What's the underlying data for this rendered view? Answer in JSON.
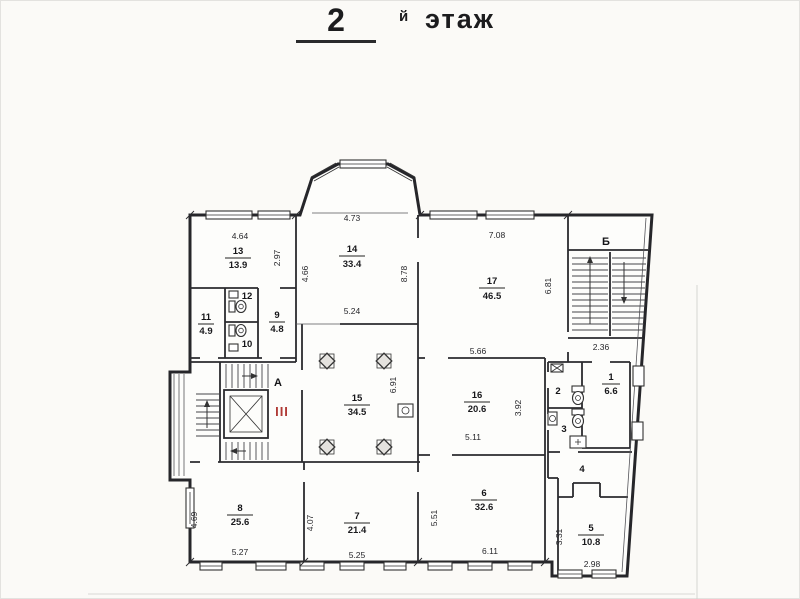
{
  "title": {
    "floor_number": "2",
    "suffix": "й",
    "word": "этаж"
  },
  "stairwells": {
    "a": "А",
    "b": "Б",
    "hatch": "III"
  },
  "rooms": {
    "r1": {
      "num": "1",
      "area": "6.6"
    },
    "r2": {
      "num": "2"
    },
    "r3": {
      "num": "3"
    },
    "r4": {
      "num": "4"
    },
    "r5": {
      "num": "5",
      "area": "10.8"
    },
    "r6": {
      "num": "6",
      "area": "32.6"
    },
    "r7": {
      "num": "7",
      "area": "21.4"
    },
    "r8": {
      "num": "8",
      "area": "25.6"
    },
    "r9": {
      "num": "9",
      "area": "4.8"
    },
    "r10": {
      "num": "10"
    },
    "r11": {
      "num": "11",
      "area": "4.9"
    },
    "r12": {
      "num": "12"
    },
    "r13": {
      "num": "13",
      "area": "13.9"
    },
    "r14": {
      "num": "14",
      "area": "33.4"
    },
    "r15": {
      "num": "15",
      "area": "34.5"
    },
    "r16": {
      "num": "16",
      "area": "20.6"
    },
    "r17": {
      "num": "17",
      "area": "46.5"
    }
  },
  "dims": {
    "r13_top": "4.64",
    "r13_right": "2.97",
    "r14_top": "4.73",
    "r14_left": "4.66",
    "r14_right": "8.78",
    "r14_bottom": "5.24",
    "r17_top": "7.08",
    "r17_right": "6.81",
    "r17_bottom": "5.66",
    "r15_right": "6.91",
    "r16_bottom": "5.11",
    "r16_right": "3.92",
    "r5_left": "3.31",
    "r5_bottom": "2.98",
    "r6_left": "5.51",
    "r6_bottom": "6.11",
    "r7_left": "4.07",
    "r7_bottom": "5.25",
    "r8_left": "4.69",
    "r8_bottom": "5.27",
    "stair_b_landing": "2.36"
  },
  "colors": {
    "ink": "#26262a",
    "accent_red": "#b03a36",
    "paper": "#fbfaf7"
  }
}
